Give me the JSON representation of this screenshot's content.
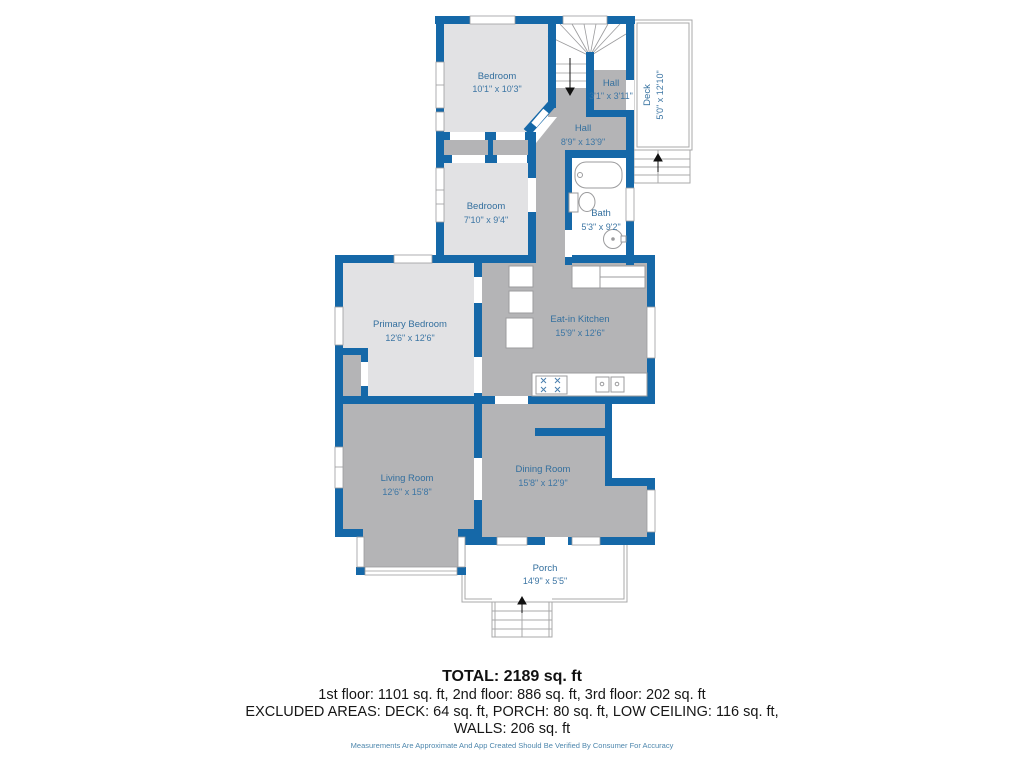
{
  "floorplan": {
    "rooms": [
      {
        "id": "bedroom-upper",
        "name": "Bedroom",
        "dims": "10'1\" x 10'3\""
      },
      {
        "id": "hall-small",
        "name": "Hall",
        "dims": "3'1\" x 3'11\""
      },
      {
        "id": "deck",
        "name": "Deck",
        "dims": "5'0\" x 12'10\""
      },
      {
        "id": "hall-main",
        "name": "Hall",
        "dims": "8'9\" x 13'9\""
      },
      {
        "id": "bedroom-mid",
        "name": "Bedroom",
        "dims": "7'10\" x 9'4\""
      },
      {
        "id": "bath",
        "name": "Bath",
        "dims": "5'3\" x 9'2\""
      },
      {
        "id": "primary-bedroom",
        "name": "Primary Bedroom",
        "dims": "12'6\" x 12'6\""
      },
      {
        "id": "kitchen",
        "name": "Eat-in Kitchen",
        "dims": "15'9\" x 12'6\""
      },
      {
        "id": "living-room",
        "name": "Living Room",
        "dims": "12'6\" x 15'8\""
      },
      {
        "id": "dining-room",
        "name": "Dining Room",
        "dims": "15'8\" x 12'9\""
      },
      {
        "id": "porch",
        "name": "Porch",
        "dims": "14'9\" x 5'5\""
      }
    ],
    "summary": {
      "total": "TOTAL: 2189 sq. ft",
      "floors": "1st floor: 1101 sq. ft, 2nd floor: 886 sq. ft, 3rd floor: 202 sq. ft",
      "excluded": "EXCLUDED AREAS: DECK: 64 sq. ft, PORCH: 80 sq. ft, LOW CEILING: 116 sq. ft,",
      "walls": "WALLS: 206 sq. ft",
      "disclaimer": "Measurements Are Approximate And App Created Should Be Verified By Consumer For Accuracy"
    },
    "colors": {
      "wall": "#1568a8",
      "room_light": "#e2e2e4",
      "room_dark": "#b4b4b6",
      "label": "#336f9e",
      "fixture_line": "#9b9b9d",
      "outline_thin": "#a8a8aa",
      "disclaimer_text": "#4e87ad",
      "summary_text": "#111111"
    }
  }
}
